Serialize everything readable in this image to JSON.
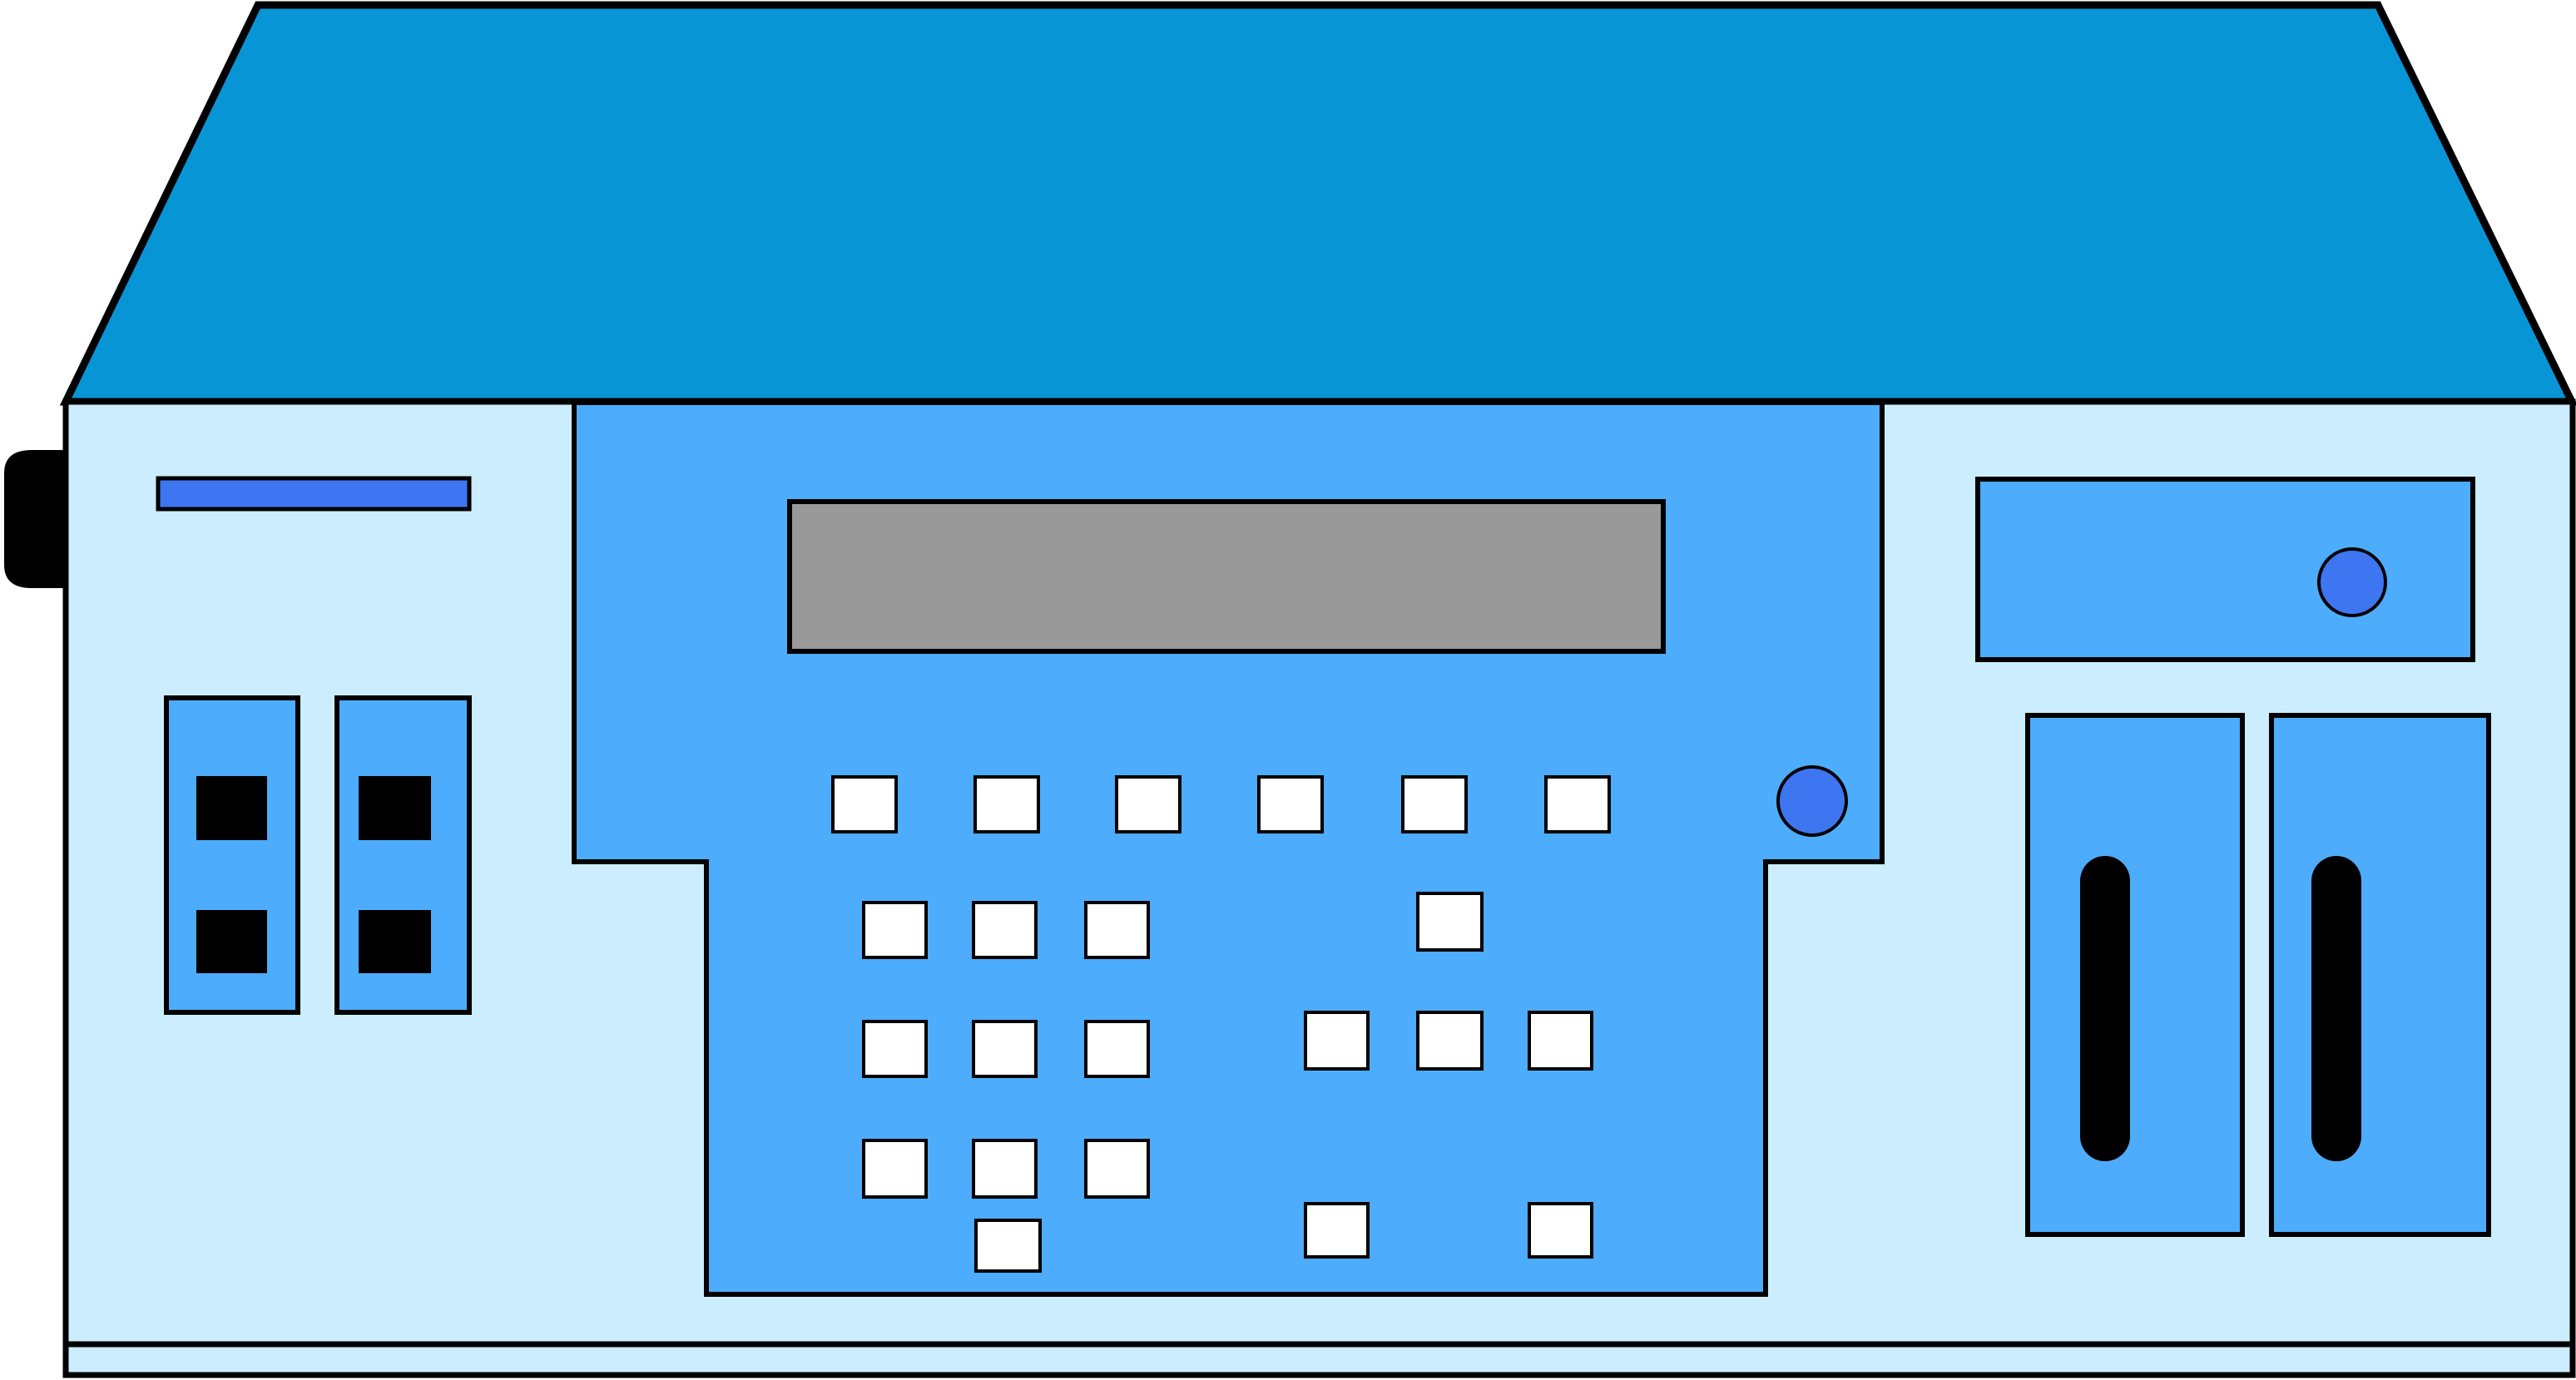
{
  "title": "Blue desktop electronic device illustration",
  "colors": {
    "background": "#FFFFFF",
    "lid": "#0895D6",
    "body": "#CBEDFE",
    "panel": "#4DACFB",
    "accent": "#3E76F2",
    "display": "#999999",
    "button_face": "#FFFFFF",
    "black": "#000000",
    "outline": "#000000"
  },
  "illustration": {
    "subject": "clipart of a desktop electronic instrument with sloped top lid, front control panel, gray display screen, white push buttons, round knobs, DIP-switch blocks, disk slot and vent slots",
    "counts": {
      "top_row_buttons": 6,
      "keypad_left_buttons": 10,
      "keypad_right_buttons": 6,
      "white_buttons_total": 22,
      "round_knobs": 2,
      "switch_blocks": 2,
      "switch_squares": 4,
      "vent_panels": 2,
      "vent_slots": 2,
      "display_screens": 1,
      "disk_slots": 1,
      "side_connectors": 1
    }
  }
}
